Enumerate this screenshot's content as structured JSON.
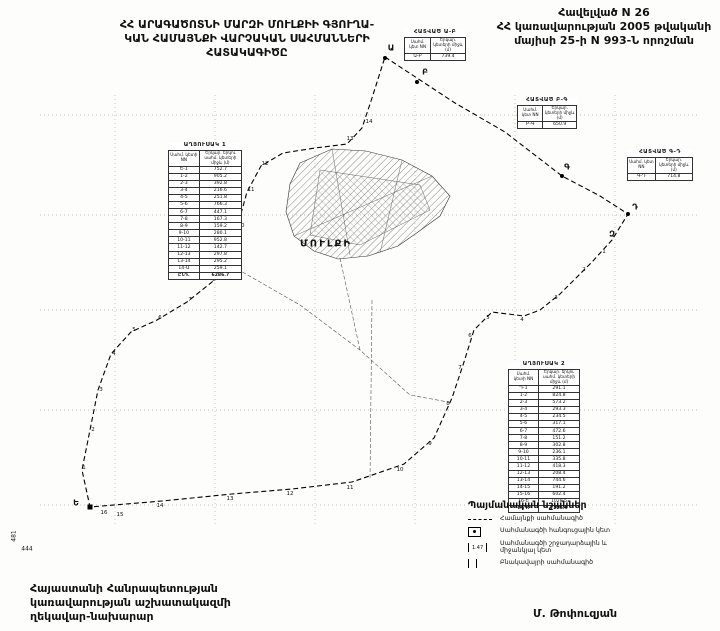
{
  "header": {
    "title_left_lines": [
      "ՀՀ ԱՐԱԳԱԾՈՏՆԻ ՄԱՐԶԻ ՄՈՒԼՔԻԻ ԳՅՈՒՂԱ-",
      "ԿԱՆ ՀԱՄԱՅՆՔԻ ՎԱՐՉԱԿԱՆ ՍԱՀՄԱՆՆԵՐԻ",
      "ՀԱՏԱԿԱԳԻԾԸ"
    ],
    "title_right_lines": [
      "Հավելված N 26",
      "ՀՀ կառավարության 2005 թվականի",
      "մայիսի 25-ի N 993-Ն որոշման"
    ]
  },
  "tables": {
    "left": {
      "title": "ԱՂՅՈՒՍԱԿ 1",
      "col1": "Սահմ. կետի NN",
      "col2": "Երկար. երկու սահմ. կետերի միջև (մ)",
      "rows": [
        [
          "Ե-1",
          "752.7"
        ],
        [
          "1-2",
          "905.2"
        ],
        [
          "2-3",
          "392.8"
        ],
        [
          "3-4",
          "216.6"
        ],
        [
          "4-5",
          "251.8"
        ],
        [
          "5-6",
          "766.3"
        ],
        [
          "6-7",
          "447.1"
        ],
        [
          "7-8",
          "167.3"
        ],
        [
          "8-9",
          "159.2"
        ],
        [
          "9-10",
          "280.1"
        ],
        [
          "10-11",
          "952.8"
        ],
        [
          "11-12",
          "142.7"
        ],
        [
          "12-13",
          "297.8"
        ],
        [
          "13-14",
          "295.2"
        ],
        [
          "14-Ա",
          "259.1"
        ]
      ],
      "total_label": "ԸՆԴ.",
      "total": "6286.7"
    },
    "right": {
      "title": "ԱՂՅՈՒՍԱԿ 2",
      "col1": "Սահմ. կետի NN",
      "col2": "Երկար. երկու սահմ. կետերի միջև (մ)",
      "rows": [
        [
          "Դ-1",
          "291.1"
        ],
        [
          "1-2",
          "824.8"
        ],
        [
          "2-3",
          "573.2"
        ],
        [
          "3-4",
          "293.3"
        ],
        [
          "4-5",
          "234.5"
        ],
        [
          "5-6",
          "317.1"
        ],
        [
          "6-7",
          "472.6"
        ],
        [
          "7-8",
          "151.2"
        ],
        [
          "8-9",
          "302.8"
        ],
        [
          "9-10",
          "236.1"
        ],
        [
          "10-11",
          "335.8"
        ],
        [
          "11-12",
          "418.3"
        ],
        [
          "12-13",
          "208.4"
        ],
        [
          "13-14",
          "744.6"
        ],
        [
          "14-15",
          "191.2"
        ],
        [
          "15-16",
          "602.4"
        ],
        [
          "16-Ե",
          "1028.5"
        ]
      ],
      "total_label": "ԸՆԴ.",
      "total": "7225.9"
    },
    "seg_ab": {
      "title": "ՀԱՏՎԱԾ Ա-Բ",
      "col1": "Սահմ. կետ NN",
      "col2": "Երկար. կետերի միջև (մ)",
      "rows": [
        [
          "Ա-Բ",
          "739.4"
        ]
      ]
    },
    "seg_bg": {
      "title": "ՀԱՏՎԱԾ Բ-Գ",
      "col1": "Սահմ. կետ NN",
      "col2": "Երկար. կետերի միջև (մ)",
      "rows": [
        [
          "Բ-Գ",
          "650.9"
        ]
      ]
    },
    "seg_gd": {
      "title": "ՀԱՏՎԱԾ Գ-Դ",
      "col1": "Սահմ. կետ NN",
      "col2": "Երկար. կետերի միջև (մ)",
      "rows": [
        [
          "Գ-Դ",
          "714.8"
        ]
      ]
    }
  },
  "map": {
    "village_label": "ՄՈՒԼՔԻ",
    "labels": [
      {
        "t": "Ա",
        "x": 391,
        "y": 48,
        "c": "node"
      },
      {
        "t": "Բ",
        "x": 425,
        "y": 72,
        "c": "node"
      },
      {
        "t": "Գ",
        "x": 567,
        "y": 167,
        "c": "node"
      },
      {
        "t": "Դ",
        "x": 635,
        "y": 207,
        "c": "node"
      },
      {
        "t": "Զ",
        "x": 612,
        "y": 234,
        "c": "node"
      },
      {
        "t": "Ե",
        "x": 76,
        "y": 503,
        "c": "node"
      },
      {
        "t": "ՄՈՒԼՔԻ",
        "x": 326,
        "y": 244,
        "c": "village"
      },
      {
        "t": "481",
        "x": 14,
        "y": 536,
        "c": "elev-rot"
      },
      {
        "t": "444",
        "x": 27,
        "y": 549,
        "c": "elev"
      },
      {
        "t": "1",
        "x": 84,
        "y": 468,
        "c": "num"
      },
      {
        "t": "2",
        "x": 93,
        "y": 430,
        "c": "num"
      },
      {
        "t": "3",
        "x": 101,
        "y": 390,
        "c": "num"
      },
      {
        "t": "4",
        "x": 114,
        "y": 354,
        "c": "num"
      },
      {
        "t": "5",
        "x": 134,
        "y": 330,
        "c": "num"
      },
      {
        "t": "6",
        "x": 160,
        "y": 318,
        "c": "num"
      },
      {
        "t": "7",
        "x": 190,
        "y": 300,
        "c": "num"
      },
      {
        "t": "8",
        "x": 214,
        "y": 280,
        "c": "num"
      },
      {
        "t": "9",
        "x": 232,
        "y": 260,
        "c": "num"
      },
      {
        "t": "10",
        "x": 241,
        "y": 226,
        "c": "num"
      },
      {
        "t": "11",
        "x": 251,
        "y": 190,
        "c": "num"
      },
      {
        "t": "12",
        "x": 265,
        "y": 164,
        "c": "num"
      },
      {
        "t": "13",
        "x": 350,
        "y": 139,
        "c": "num"
      },
      {
        "t": "14",
        "x": 369,
        "y": 122,
        "c": "num"
      },
      {
        "t": "1",
        "x": 604,
        "y": 252,
        "c": "num"
      },
      {
        "t": "2",
        "x": 584,
        "y": 270,
        "c": "num"
      },
      {
        "t": "3",
        "x": 556,
        "y": 298,
        "c": "num"
      },
      {
        "t": "4",
        "x": 522,
        "y": 320,
        "c": "num"
      },
      {
        "t": "5",
        "x": 488,
        "y": 318,
        "c": "num"
      },
      {
        "t": "6",
        "x": 470,
        "y": 336,
        "c": "num"
      },
      {
        "t": "7",
        "x": 460,
        "y": 368,
        "c": "num"
      },
      {
        "t": "8",
        "x": 448,
        "y": 404,
        "c": "num"
      },
      {
        "t": "9",
        "x": 430,
        "y": 444,
        "c": "num"
      },
      {
        "t": "10",
        "x": 400,
        "y": 470,
        "c": "num"
      },
      {
        "t": "11",
        "x": 350,
        "y": 488,
        "c": "num"
      },
      {
        "t": "12",
        "x": 290,
        "y": 494,
        "c": "num"
      },
      {
        "t": "13",
        "x": 230,
        "y": 499,
        "c": "num"
      },
      {
        "t": "14",
        "x": 160,
        "y": 506,
        "c": "num"
      },
      {
        "t": "15",
        "x": 120,
        "y": 515,
        "c": "num"
      },
      {
        "t": "16",
        "x": 104,
        "y": 513,
        "c": "num"
      }
    ],
    "markers": [
      {
        "x": 385,
        "y": 58,
        "s": "dot"
      },
      {
        "x": 417,
        "y": 82,
        "s": "dot"
      },
      {
        "x": 562,
        "y": 176,
        "s": "dot"
      },
      {
        "x": 628,
        "y": 214,
        "s": "dot"
      },
      {
        "x": 90,
        "y": 507,
        "s": "sq"
      }
    ]
  },
  "legend": {
    "title": "Պայմանական նշաններ",
    "items": [
      {
        "label": "Համայնքի սահմանագիծ"
      },
      {
        "label": "Սահմանագծի հանգուցային կետ"
      },
      {
        "label": "Սահմանագծի շրջադարձային և միջանկյալ կետ",
        "symbol_value": "1.47"
      },
      {
        "label": "Բնակավայրի սահմանագիծ"
      }
    ]
  },
  "footer": {
    "left_lines": [
      "Հայաստանի Հանրապետության",
      "կառավարության աշխատակազմի",
      "ղեկավար-նախարար"
    ],
    "signature": "Մ. Թոփուզյան"
  }
}
